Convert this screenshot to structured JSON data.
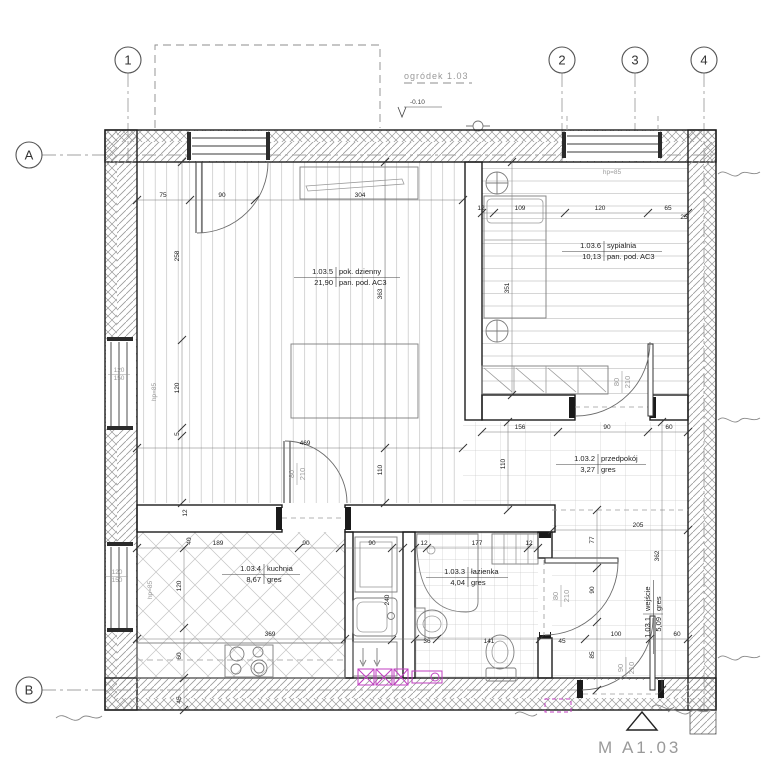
{
  "grid": {
    "cols": [
      "1",
      "2",
      "3",
      "4"
    ],
    "rows": [
      "A",
      "B"
    ]
  },
  "site": {
    "garden_label": "ogródek 1.03",
    "level": "-0.10"
  },
  "sheet_marker": "M  A1.03",
  "rooms": [
    {
      "number": "1.03.5",
      "name": "pok. dzienny",
      "area": "21,90",
      "floor": "pan. pod. AC3"
    },
    {
      "number": "1.03.6",
      "name": "sypialnia",
      "area": "10,13",
      "floor": "pan. pod. AC3"
    },
    {
      "number": "1.03.2",
      "name": "przedpokój",
      "area": "3,27",
      "floor": "gres"
    },
    {
      "number": "1.03.4",
      "name": "kuchnia",
      "area": "8,67",
      "floor": "gres"
    },
    {
      "number": "1.03.3",
      "name": "łazienka",
      "area": "4,04",
      "floor": "gres"
    },
    {
      "number": "1.03.1",
      "name": "wejście",
      "area": "5,09",
      "floor": "gres"
    }
  ],
  "doors": [
    {
      "w": "80",
      "h": "210"
    },
    {
      "w": "80",
      "h": "210"
    },
    {
      "w": "80",
      "h": "210"
    },
    {
      "w": "90",
      "h": "210"
    }
  ],
  "windows": [
    {
      "w": "120",
      "h": "150",
      "sill": "hp=85"
    },
    {
      "w": "120",
      "h": "150",
      "sill": "hp=85"
    },
    {
      "sill": "hp=85"
    }
  ],
  "dimensions": [
    {
      "v": "75",
      "x": 163,
      "y": 197
    },
    {
      "v": "90",
      "x": 222,
      "y": 197
    },
    {
      "v": "304",
      "x": 360,
      "y": 197
    },
    {
      "v": "12",
      "x": 481,
      "y": 210
    },
    {
      "v": "109",
      "x": 520,
      "y": 210
    },
    {
      "v": "120",
      "x": 600,
      "y": 210
    },
    {
      "v": "65",
      "x": 668,
      "y": 210
    },
    {
      "v": "25",
      "x": 684,
      "y": 219
    },
    {
      "v": "258",
      "x": 179,
      "y": 256,
      "r": -90
    },
    {
      "v": "120",
      "x": 179,
      "y": 388,
      "r": -90
    },
    {
      "v": "5",
      "x": 179,
      "y": 434,
      "r": -90
    },
    {
      "v": "363",
      "x": 382,
      "y": 294,
      "r": -90
    },
    {
      "v": "469",
      "x": 305,
      "y": 445
    },
    {
      "v": "110",
      "x": 382,
      "y": 470,
      "r": -90
    },
    {
      "v": "351",
      "x": 509,
      "y": 288,
      "r": -90
    },
    {
      "v": "156",
      "x": 520,
      "y": 429
    },
    {
      "v": "90",
      "x": 607,
      "y": 429
    },
    {
      "v": "60",
      "x": 669,
      "y": 429
    },
    {
      "v": "110",
      "x": 505,
      "y": 464,
      "r": -90
    },
    {
      "v": "205",
      "x": 638,
      "y": 527
    },
    {
      "v": "77",
      "x": 594,
      "y": 540,
      "r": -90
    },
    {
      "v": "90",
      "x": 594,
      "y": 590,
      "r": -90
    },
    {
      "v": "85",
      "x": 594,
      "y": 655,
      "r": -90
    },
    {
      "v": "362",
      "x": 659,
      "y": 556,
      "r": -90
    },
    {
      "v": "100",
      "x": 616,
      "y": 636
    },
    {
      "v": "60",
      "x": 677,
      "y": 636
    },
    {
      "v": "12",
      "x": 187,
      "y": 513,
      "r": -90
    },
    {
      "v": "40",
      "x": 191,
      "y": 541,
      "r": -90
    },
    {
      "v": "189",
      "x": 218,
      "y": 545
    },
    {
      "v": "90",
      "x": 306,
      "y": 545
    },
    {
      "v": "90",
      "x": 372,
      "y": 545
    },
    {
      "v": "120",
      "x": 181,
      "y": 586,
      "r": -90
    },
    {
      "v": "240",
      "x": 389,
      "y": 600,
      "r": -90
    },
    {
      "v": "369",
      "x": 270,
      "y": 636
    },
    {
      "v": "60",
      "x": 181,
      "y": 656,
      "r": -90
    },
    {
      "v": "45",
      "x": 181,
      "y": 700,
      "r": -90
    },
    {
      "v": "12",
      "x": 424,
      "y": 545
    },
    {
      "v": "177",
      "x": 477,
      "y": 545
    },
    {
      "v": "12",
      "x": 529,
      "y": 545
    },
    {
      "v": "36",
      "x": 427,
      "y": 643
    },
    {
      "v": "141",
      "x": 489,
      "y": 643
    },
    {
      "v": "45",
      "x": 562,
      "y": 643
    }
  ]
}
